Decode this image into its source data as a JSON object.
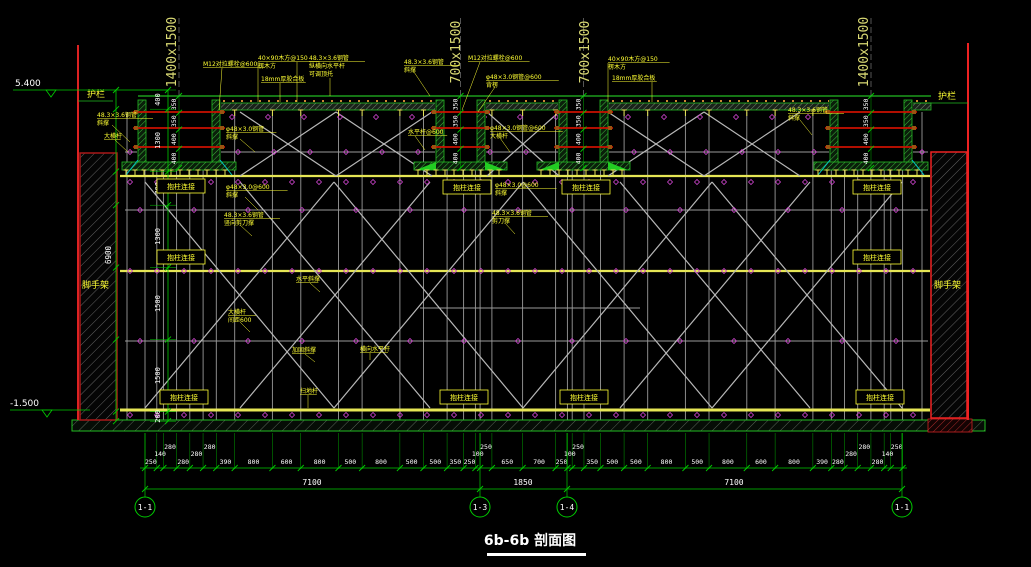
{
  "drawing": {
    "title": "6b-6b 剖面图",
    "elevation_top": "5.400",
    "elevation_bottom": "-1.500",
    "guardrail": "护栏",
    "scaffold": "脚手架",
    "column_brace_box": "抱柱连接",
    "beam_size_labels": [
      "1400x1500",
      "700x1500",
      "700x1500",
      "1400x1500"
    ],
    "beam_inner_dims": [
      "350",
      "350",
      "400",
      "400"
    ],
    "left_dims": {
      "values": [
        "400",
        "1300",
        "700",
        "1300",
        "1500",
        "1500",
        "200"
      ],
      "total": "6900"
    },
    "bottom_dims": {
      "values": [
        "250",
        "140",
        "280",
        "280",
        "280",
        "280",
        "390",
        "800",
        "600",
        "800",
        "500",
        "800",
        "500",
        "500",
        "350",
        "250",
        "100",
        "250",
        "650",
        "700",
        "250",
        "100",
        "250",
        "350",
        "500",
        "500",
        "800",
        "500",
        "800",
        "600",
        "800",
        "390",
        "280",
        "280",
        "280",
        "280",
        "140",
        "250"
      ],
      "totals": [
        "7100",
        "1850",
        "7100"
      ]
    },
    "grid_bubbles": [
      "1-1",
      "1-3",
      "1-4",
      "1-1"
    ],
    "callouts": [
      [
        "M12对拉螺栓@600"
      ],
      [
        "40×90木方@150",
        "楞木方"
      ],
      [
        "18mm厚胶合板"
      ],
      [
        "48.3×3.6钢管",
        "纵横向水平杆",
        "可调顶托"
      ],
      [
        "48.3×3.6钢管",
        "斜撑"
      ],
      [
        "M12对拉螺栓@600"
      ],
      [
        "φ48×3.0钢管@600",
        "背楞"
      ],
      [
        "40×90木方@150",
        "楞木方"
      ],
      [
        "18mm厚胶合板"
      ],
      [
        "48.3×3.6钢管",
        "斜撑"
      ],
      [
        "48.3×3.6钢管",
        "斜撑"
      ],
      [
        "大横杆"
      ],
      [
        "φ48×3.0钢管",
        "斜撑"
      ],
      [
        "水平杆@600"
      ],
      [
        "φ48×3.0钢管@600",
        "大横杆"
      ],
      [
        "φ48×3.0@600",
        "斜撑"
      ],
      [
        "48.3×3.6钢管",
        "竖向剪刀撑"
      ],
      [
        "水平斜撑"
      ],
      [
        "大横杆",
        "间距600"
      ],
      [
        "加固斜撑"
      ],
      [
        "横向水平杆"
      ],
      [
        "扫地杆"
      ],
      [
        "48.3×3.6钢管",
        "剪刀撑"
      ],
      [
        "φ48×3.0@600",
        "斜撑"
      ]
    ]
  },
  "colors": {
    "background": "#000000",
    "dimension_green": "#00cc00",
    "structure_green": "#22bb22",
    "callout_yellow": "#ffff33",
    "ledger_yellow": "#e6e655",
    "scaffold_gray": "#b0b0b0",
    "wall_red": "#dd2222",
    "tie_rod_red": "#cc1100",
    "marker_magenta": "#cc44cc",
    "kicker_cyan": "#00cccc",
    "text_white": "#ffffff",
    "size_label_khaki": "#d9d973"
  }
}
